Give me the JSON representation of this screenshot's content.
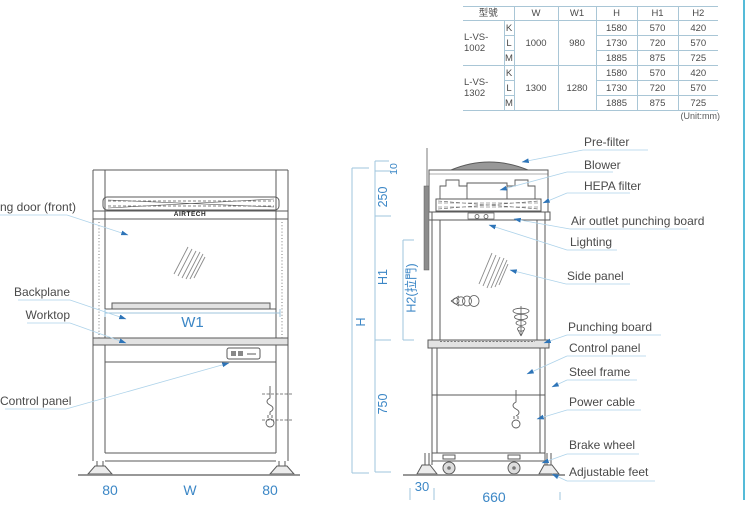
{
  "table": {
    "headers": {
      "model": "型號",
      "w": "W",
      "w1": "W1",
      "h": "H",
      "h1": "H1",
      "h2": "H2"
    },
    "unit_note": "(Unit:mm)",
    "groups": [
      {
        "model": "L-VS-1002",
        "w": "1000",
        "w1": "980",
        "rows": [
          {
            "size": "K",
            "h": "1580",
            "h1": "570",
            "h2": "420"
          },
          {
            "size": "L",
            "h": "1730",
            "h1": "720",
            "h2": "570"
          },
          {
            "size": "M",
            "h": "1885",
            "h1": "875",
            "h2": "725"
          }
        ]
      },
      {
        "model": "L-VS-1302",
        "w": "1300",
        "w1": "1280",
        "rows": [
          {
            "size": "K",
            "h": "1580",
            "h1": "570",
            "h2": "420"
          },
          {
            "size": "L",
            "h": "1730",
            "h1": "720",
            "h2": "570"
          },
          {
            "size": "M",
            "h": "1885",
            "h1": "875",
            "h2": "725"
          }
        ]
      }
    ]
  },
  "front_view": {
    "brand": "AIRTECH",
    "labels": {
      "door_front": "ng door (front)",
      "backplane": "Backplane",
      "worktop": "Worktop",
      "control_panel": "Control panel"
    },
    "dims": {
      "w1": "W1",
      "d80_left": "80",
      "w": "W",
      "d80_right": "80"
    }
  },
  "side_view": {
    "labels": {
      "pre_filter": "Pre-filter",
      "blower": "Blower",
      "hepa_filter": "HEPA filter",
      "air_outlet": "Air outlet punching board",
      "lighting": "Lighting",
      "side_panel": "Side panel",
      "punching_board": "Punching board",
      "control_panel": "Control panel",
      "steel_frame": "Steel frame",
      "power_cable": "Power cable",
      "brake_wheel": "Brake wheel",
      "adjustable_feet": "Adjustable feet"
    },
    "dims": {
      "h": "H",
      "h1": "H1",
      "h2_door": "H2(拉門)",
      "d10": "10",
      "d250": "250",
      "d750": "750",
      "d30": "30",
      "d660": "660"
    }
  },
  "colors": {
    "dimension_blue": "#3c87c6",
    "arrow_blue": "#2d74b8",
    "leader_blue": "#aed3ea",
    "line_gray": "#5a5a5a",
    "table_border": "#a9c6d6",
    "page_border": "#55bbd8"
  }
}
